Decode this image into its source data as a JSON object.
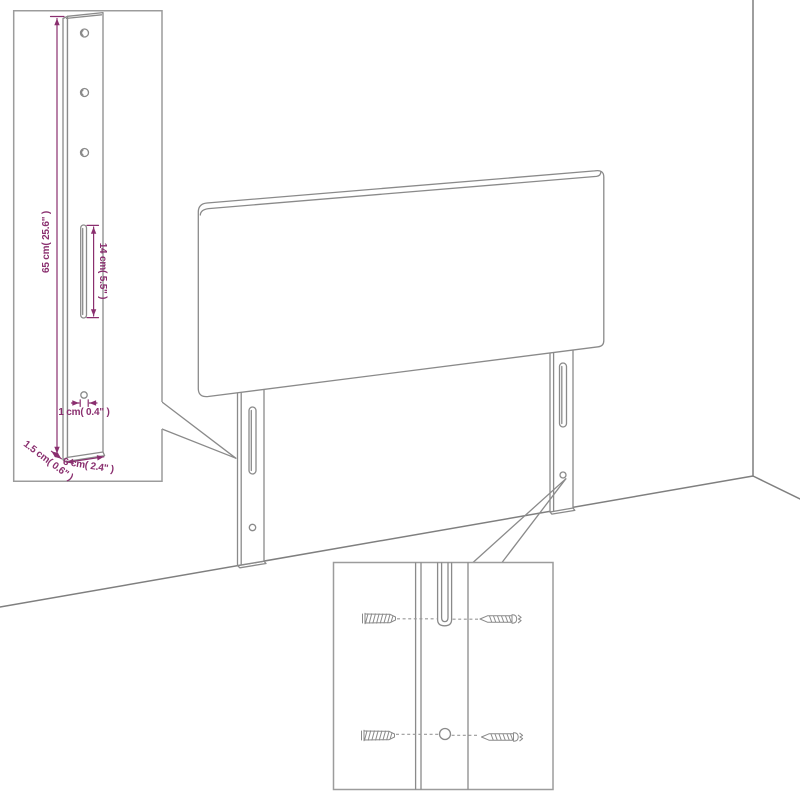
{
  "diagram_type": "headboard-assembly-dimension-diagram",
  "subject": "upholstered headboard with two slotted mounting legs in a room corner",
  "colors": {
    "line": "#8a8a8a",
    "dimension": "#8a2f6f",
    "background": "#ffffff",
    "callout_border": "#9c9c9c"
  },
  "labels": {
    "height": "65 cm( 25.6\" )",
    "slot_height": "14 cm( 5.5\" )",
    "hole_diameter": "1 cm( 0.4\" )",
    "leg_thickness": "1.5 cm( 0.6\" )",
    "leg_width": "6 cm( 2.4\" )"
  },
  "icons": {
    "wall_plug": "wall-plug-icon",
    "screw": "screw-icon"
  }
}
